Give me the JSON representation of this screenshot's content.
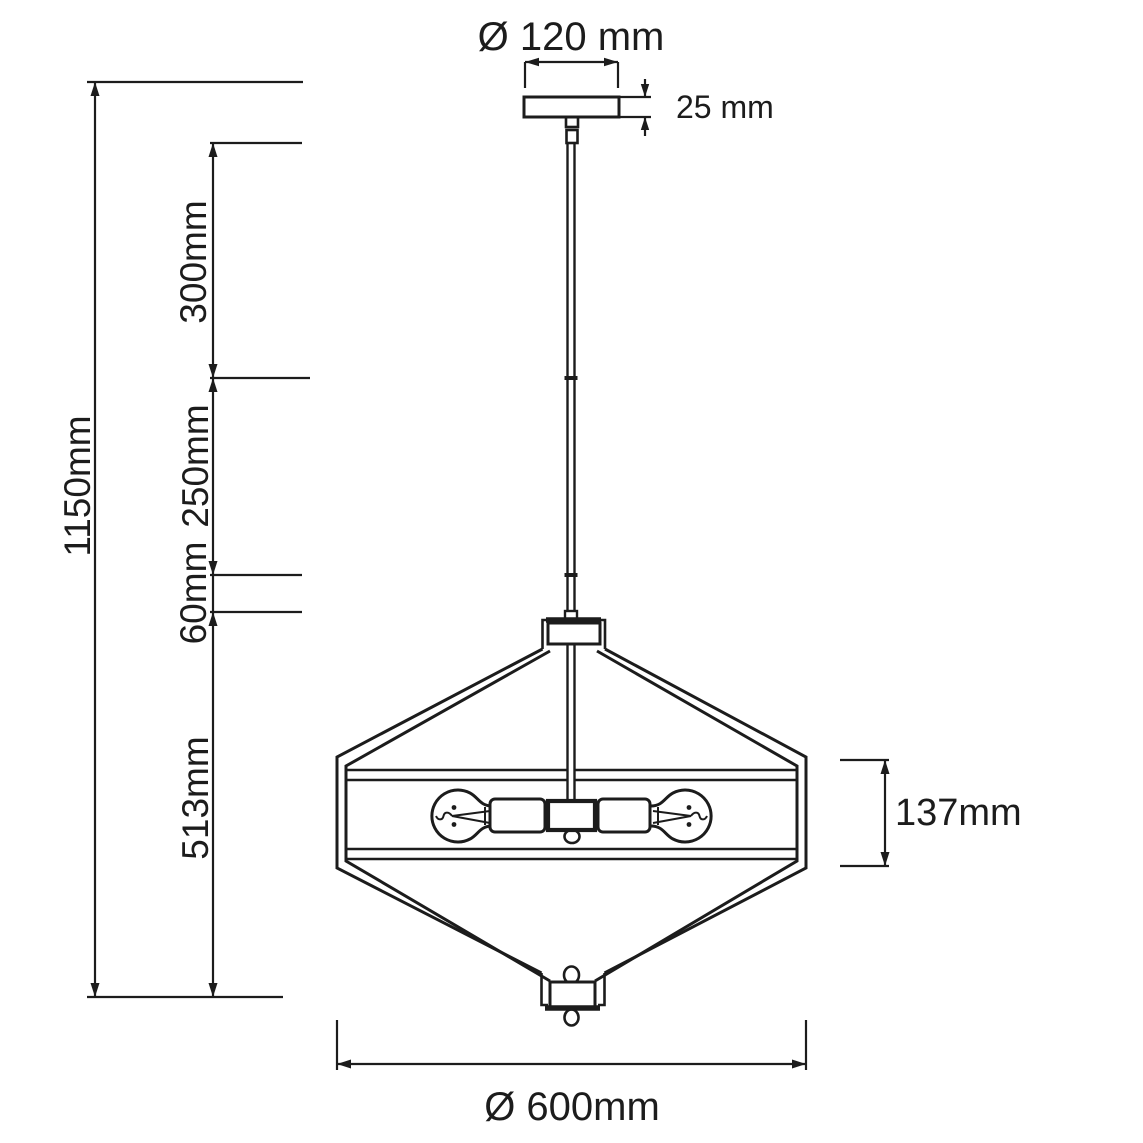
{
  "drawing": {
    "title": "pendant-lamp-dimension-drawing",
    "dimensions": {
      "canopy_diameter": {
        "label": "Ø 120 mm",
        "value_mm": 120
      },
      "canopy_thickness": {
        "label": "25 mm",
        "value_mm": 25
      },
      "overall_height": {
        "label": "1150mm",
        "value_mm": 1150
      },
      "rod_section_upper": {
        "label": "300mm",
        "value_mm": 300
      },
      "rod_section_middle": {
        "label": "250mm",
        "value_mm": 250
      },
      "rod_section_lower": {
        "label": "60mm",
        "value_mm": 60
      },
      "shade_height": {
        "label": "513mm",
        "value_mm": 513
      },
      "band_height": {
        "label": "137mm",
        "value_mm": 137
      },
      "shade_diameter": {
        "label": "Ø 600mm",
        "value_mm": 600
      }
    }
  }
}
